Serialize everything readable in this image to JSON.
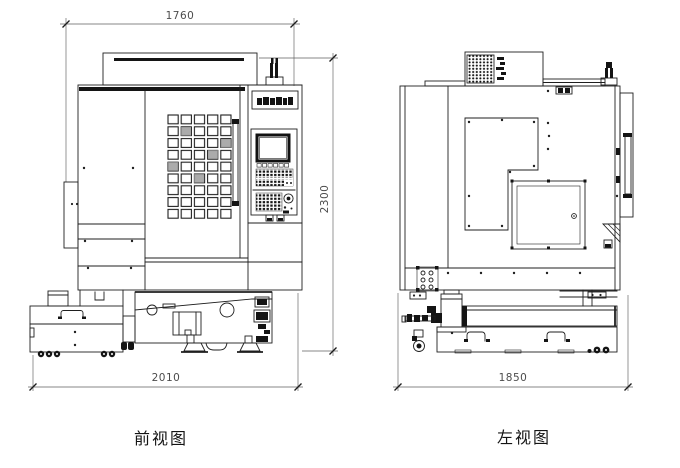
{
  "page": {
    "background": "#ffffff"
  },
  "drawing": {
    "type": "engineering-orthographic-drawing",
    "subject": "CNC vertical machining center",
    "colors": {
      "line": "#1f1f1f",
      "dimension": "#4c4c4c",
      "background": "#ffffff"
    },
    "views": [
      {
        "id": "front",
        "label": "前视图",
        "dimensions": {
          "top_width": "1760",
          "right_height": "2300",
          "bottom_width": "2010"
        }
      },
      {
        "id": "left",
        "label": "左视图",
        "dimensions": {
          "bottom_width": "1850"
        }
      }
    ],
    "icons": {
      "brand_nameplate": "machine-brand-logo",
      "vent_grille": "dot-matrix-vent",
      "jog_knob": "rotary-dial"
    }
  }
}
